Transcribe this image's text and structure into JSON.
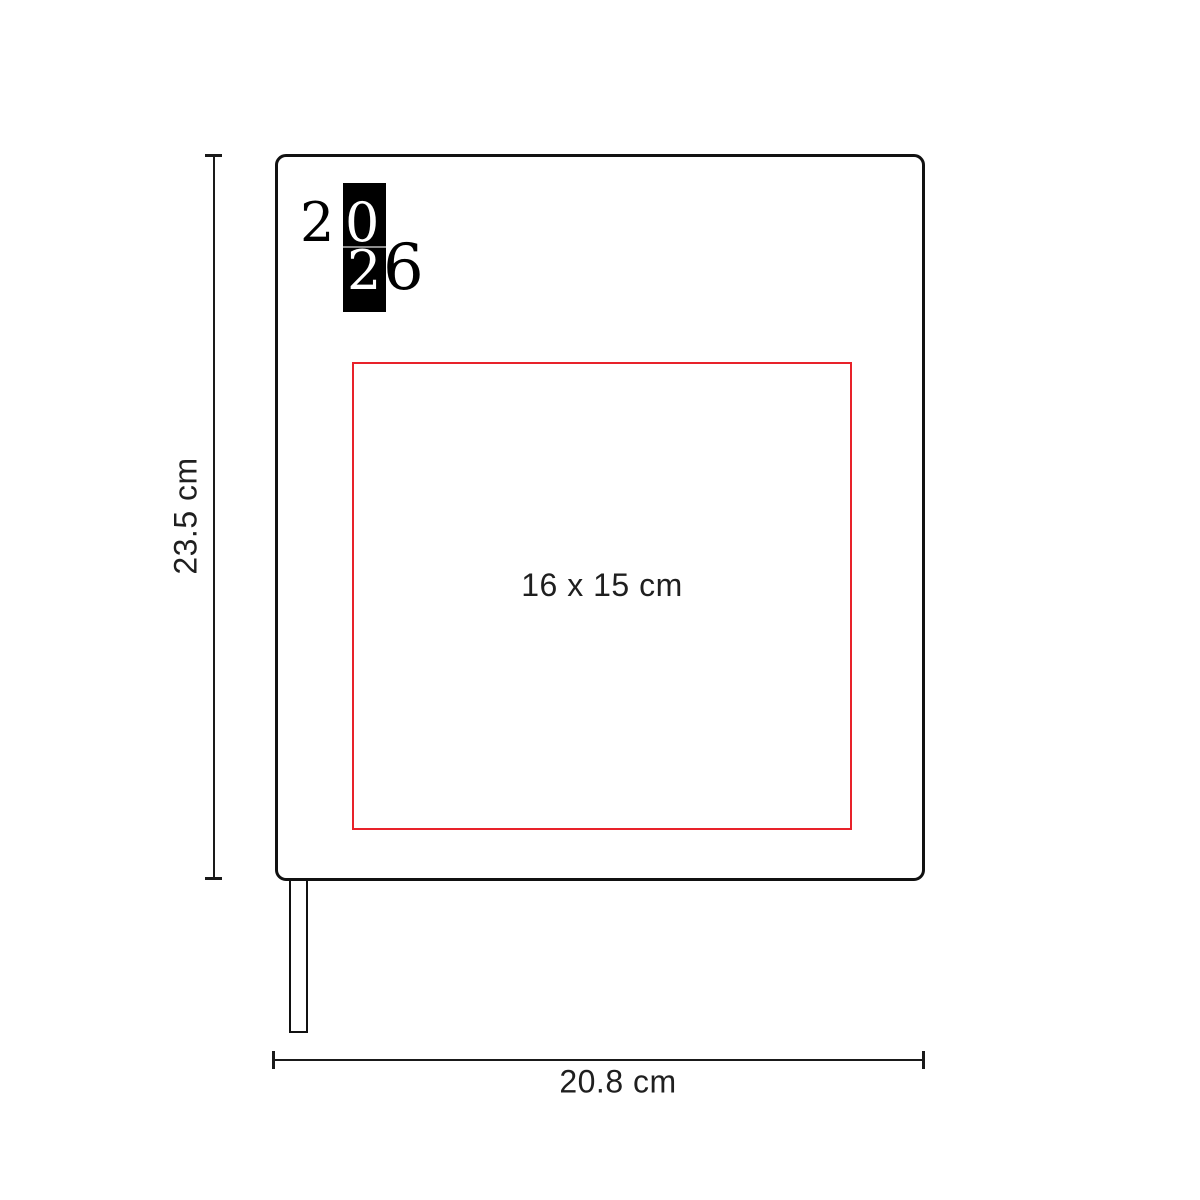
{
  "labels": {
    "height": "23.5 cm",
    "width": "20.8 cm",
    "print_area": "16 x 15 cm"
  },
  "logo": {
    "year": "2026",
    "digits": [
      "2",
      "0",
      "2",
      "6"
    ]
  },
  "colors": {
    "outline": "#111111",
    "dimension_line": "#1a1a1a",
    "print_area_red": "#e8222a",
    "label_text": "#1f1f1f",
    "logo_block": "#000000",
    "logo_digit_light": "#ffffff",
    "background": "#ffffff"
  }
}
